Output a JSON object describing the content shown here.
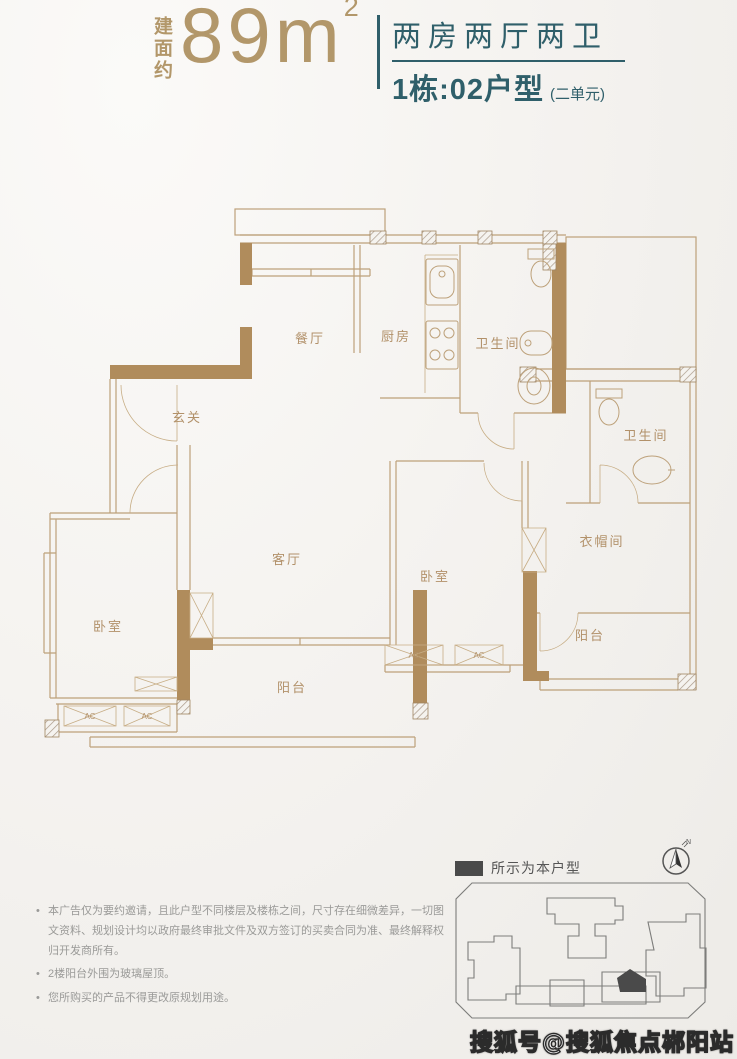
{
  "header": {
    "area_label": "建面约",
    "area_value": "89",
    "area_unit": "m",
    "area_exponent": "2",
    "layout_type": "两房两厅两卫",
    "unit_title": "1栋:02户型",
    "unit_subtitle": "(二单元)"
  },
  "plan": {
    "rooms": {
      "dining": "餐厅",
      "kitchen": "厨房",
      "bath_top": "卫生间",
      "entry": "玄关",
      "living": "客厅",
      "bedroom_main": "卧室",
      "bedroom_left": "卧室",
      "cloakroom": "衣帽间",
      "balcony_main": "阳台",
      "balcony_right": "阳台",
      "bath_right": "卫生间",
      "ac": "AC"
    }
  },
  "legend": {
    "label": "所示为本户型"
  },
  "compass": {
    "label": "N"
  },
  "notes": {
    "items": [
      "本广告仅为要约邀请，且此户型不同楼层及楼栋之间，尺寸存在细微差异，一切图文资料、规划设计均以政府最终审批文件及双方签订的买卖合同为准、最终解释权归开发商所有。",
      "2楼阳台外围为玻璃屋顶。",
      "您所购买的产品不得更改原规划用途。"
    ]
  },
  "watermark": {
    "text": "搜狐号@搜狐焦点郴阳站"
  },
  "colors": {
    "tan": "#b2976a",
    "teal": "#2f5f6a",
    "wall": "#b08c5c",
    "line": "#bda17a",
    "highlight": "#4a4a4a"
  }
}
